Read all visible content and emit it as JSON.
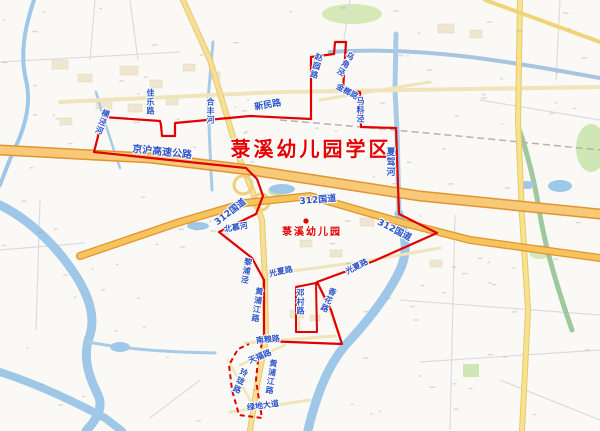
{
  "district": {
    "title": "菉溪幼儿园学区",
    "poi_name": "菉溪幼儿园"
  },
  "colors": {
    "boundary_red": "#e00000",
    "title_red": "#e60000",
    "road_label_blue": "#2d54c8",
    "highway_fill": "#f6c35c",
    "highway_casing": "#e0952f",
    "minor_road_fill": "#f0e4ba",
    "water_blue": "#9ec7e8",
    "park_green": "#d4e8b8"
  },
  "map_labels": [
    {
      "name": "district-title",
      "text": "菉溪幼儿园学区",
      "x": 311,
      "y": 149,
      "size": 20,
      "color": "red",
      "style": "title",
      "rotate": 0,
      "vertical": false
    },
    {
      "name": "poi-label-kindergarten",
      "text": "菉溪幼儿园",
      "x": 312,
      "y": 233,
      "size": 10,
      "color": "red",
      "style": "poi",
      "rotate": 0,
      "vertical": false
    },
    {
      "name": "road-label-jinghu-expressway",
      "text": "京沪高速公路",
      "x": 162,
      "y": 153,
      "size": 10,
      "color": "blue",
      "rotate": 6,
      "vertical": false
    },
    {
      "name": "road-label-g312-left",
      "text": "312国道",
      "x": 231,
      "y": 213,
      "size": 9,
      "color": "blue",
      "rotate": -38,
      "vertical": false
    },
    {
      "name": "road-label-g312-center",
      "text": "312国道",
      "x": 318,
      "y": 201,
      "size": 9,
      "color": "blue",
      "rotate": -5,
      "vertical": false
    },
    {
      "name": "road-label-g312-right",
      "text": "312国道",
      "x": 394,
      "y": 231,
      "size": 9,
      "color": "blue",
      "rotate": 27,
      "vertical": false
    },
    {
      "name": "road-label-xinmin-road",
      "text": "新民路",
      "x": 268,
      "y": 106,
      "size": 9,
      "color": "blue",
      "rotate": -10,
      "vertical": false
    },
    {
      "name": "road-label-jiale-road",
      "text": "佳乐路",
      "x": 150,
      "y": 102,
      "size": 8,
      "color": "blue",
      "rotate": 0,
      "vertical": true
    },
    {
      "name": "river-label-hefeng-river",
      "text": "合丰河",
      "x": 210,
      "y": 111,
      "size": 8,
      "color": "blue",
      "rotate": 0,
      "vertical": true
    },
    {
      "name": "river-label-hengjing-river",
      "text": "横泾河",
      "x": 102,
      "y": 122,
      "size": 8,
      "color": "blue",
      "rotate": 20,
      "vertical": true
    },
    {
      "name": "road-label-zhaoyuan-road",
      "text": "赵园路",
      "x": 316,
      "y": 66,
      "size": 8,
      "color": "blue",
      "rotate": 15,
      "vertical": true
    },
    {
      "name": "river-label-wujiaojing",
      "text": "乌角泾",
      "x": 345,
      "y": 64,
      "size": 8,
      "color": "blue",
      "rotate": 30,
      "vertical": true
    },
    {
      "name": "road-label-jinlang-road",
      "text": "金榔路",
      "x": 347,
      "y": 92,
      "size": 8,
      "color": "blue",
      "rotate": 28,
      "vertical": false
    },
    {
      "name": "river-label-maliaojing",
      "text": "马料泾",
      "x": 360,
      "y": 110,
      "size": 8,
      "color": "blue",
      "rotate": 0,
      "vertical": true
    },
    {
      "name": "river-label-xiajia-river",
      "text": "夏驾河",
      "x": 389,
      "y": 162,
      "size": 9,
      "color": "blue",
      "rotate": 0,
      "vertical": true
    },
    {
      "name": "river-label-beimu-river",
      "text": "北慕河",
      "x": 236,
      "y": 228,
      "size": 8,
      "color": "blue",
      "rotate": -10,
      "vertical": false
    },
    {
      "name": "river-label-lipujing",
      "text": "黎浦泾",
      "x": 246,
      "y": 271,
      "size": 8,
      "color": "blue",
      "rotate": 10,
      "vertical": true
    },
    {
      "name": "road-label-huangpujiang-road-upper",
      "text": "黄浦江路",
      "x": 257,
      "y": 305,
      "size": 8,
      "color": "blue",
      "rotate": 8,
      "vertical": true
    },
    {
      "name": "road-label-guangxia-road-center",
      "text": "光夏路",
      "x": 281,
      "y": 272,
      "size": 8,
      "color": "blue",
      "rotate": -12,
      "vertical": false
    },
    {
      "name": "road-label-guangxia-road-right",
      "text": "光夏路",
      "x": 357,
      "y": 267,
      "size": 8,
      "color": "blue",
      "rotate": -27,
      "vertical": false
    },
    {
      "name": "road-label-dengcun-road",
      "text": "邓村路",
      "x": 300,
      "y": 302,
      "size": 8,
      "color": "blue",
      "rotate": 0,
      "vertical": true
    },
    {
      "name": "road-label-xianghua-road",
      "text": "香花路",
      "x": 328,
      "y": 300,
      "size": 8,
      "color": "blue",
      "rotate": 25,
      "vertical": true
    },
    {
      "name": "road-label-nanliang-road",
      "text": "南粮路",
      "x": 268,
      "y": 340,
      "size": 8,
      "color": "blue",
      "rotate": -6,
      "vertical": false
    },
    {
      "name": "road-label-tianfu-road",
      "text": "天福路",
      "x": 260,
      "y": 357,
      "size": 8,
      "color": "blue",
      "rotate": -22,
      "vertical": false
    },
    {
      "name": "road-label-huangpujiang-road-lower",
      "text": "黄浦江路",
      "x": 271,
      "y": 377,
      "size": 8,
      "color": "blue",
      "rotate": 8,
      "vertical": true
    },
    {
      "name": "road-label-linglong-road",
      "text": "玲珑路",
      "x": 240,
      "y": 381,
      "size": 8,
      "color": "blue",
      "rotate": 22,
      "vertical": true
    },
    {
      "name": "road-label-lvdi-avenue",
      "text": "绿地大道",
      "x": 263,
      "y": 406,
      "size": 8,
      "color": "blue",
      "rotate": -8,
      "vertical": false
    }
  ]
}
